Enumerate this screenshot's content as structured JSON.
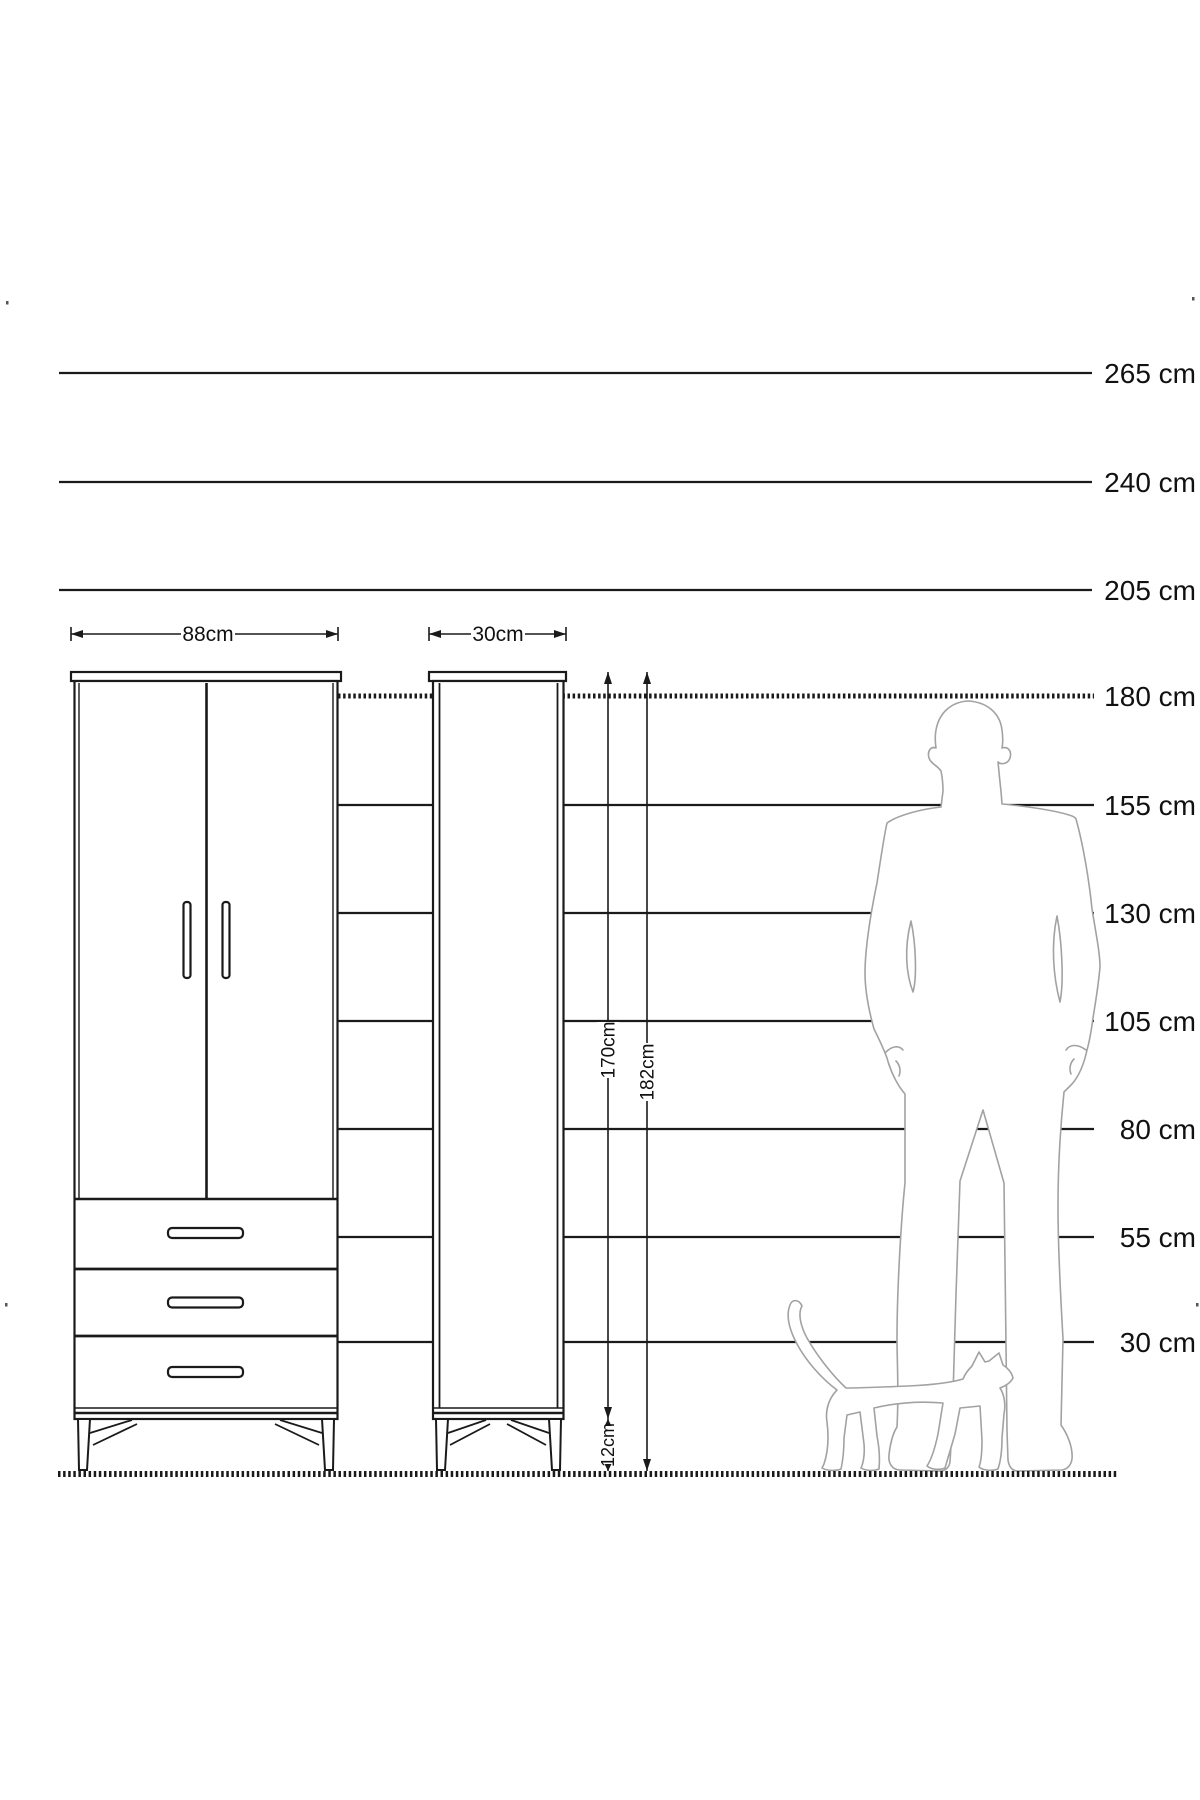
{
  "diagram": {
    "type": "furniture-dimension-diagram",
    "unit": "cm",
    "colors": {
      "ink": "#1a1a1a",
      "label": "#111111",
      "silhouette": "#a2a2a2",
      "background": "#ffffff"
    },
    "ruler": {
      "label_x": 1196,
      "font_px": 28,
      "lines": [
        {
          "label": "265 cm",
          "value": 265,
          "y": 373,
          "x1": 59,
          "x2": 1092,
          "hatched": false
        },
        {
          "label": "240 cm",
          "value": 240,
          "y": 482,
          "x1": 59,
          "x2": 1092,
          "hatched": false
        },
        {
          "label": "205 cm",
          "value": 205,
          "y": 590,
          "x1": 59,
          "x2": 1092,
          "hatched": false
        },
        {
          "label": "180 cm",
          "value": 180,
          "y": 696,
          "x1": 338,
          "x2": 1094,
          "hatched": true
        },
        {
          "label": "155 cm",
          "value": 155,
          "y": 805,
          "x1": 338,
          "x2": 1094,
          "hatched": false
        },
        {
          "label": "130 cm",
          "value": 130,
          "y": 913,
          "x1": 338,
          "x2": 1094,
          "hatched": false
        },
        {
          "label": "105 cm",
          "value": 105,
          "y": 1021,
          "x1": 338,
          "x2": 1094,
          "hatched": false
        },
        {
          "label": "80 cm",
          "value": 80,
          "y": 1129,
          "x1": 338,
          "x2": 1094,
          "hatched": false
        },
        {
          "label": "55 cm",
          "value": 55,
          "y": 1237,
          "x1": 338,
          "x2": 1094,
          "hatched": false
        },
        {
          "label": "30 cm",
          "value": 30,
          "y": 1342,
          "x1": 338,
          "x2": 1094,
          "hatched": false
        }
      ]
    },
    "dimensions": {
      "wardrobe_width": {
        "label": "88cm",
        "y": 634,
        "x1": 71,
        "x2": 338,
        "text_cx": 208
      },
      "cabinet_width": {
        "label": "30cm",
        "y": 634,
        "x1": 429,
        "x2": 566,
        "text_cx": 498
      },
      "body_height": {
        "label": "170cm",
        "x": 608,
        "y1": 672,
        "y2": 1419,
        "text_cy": 1050
      },
      "total_height": {
        "label": "182cm",
        "x": 647,
        "y1": 672,
        "y2": 1471,
        "text_cy": 1072
      },
      "leg_height": {
        "label": "12cm",
        "x": 608,
        "y1": 1419,
        "y2": 1471,
        "text_cy": 1445
      }
    },
    "ground": {
      "y": 1474,
      "x1": 58,
      "x2": 1118
    },
    "figures": {
      "man": "man-silhouette",
      "cat": "cat-silhouette"
    }
  }
}
